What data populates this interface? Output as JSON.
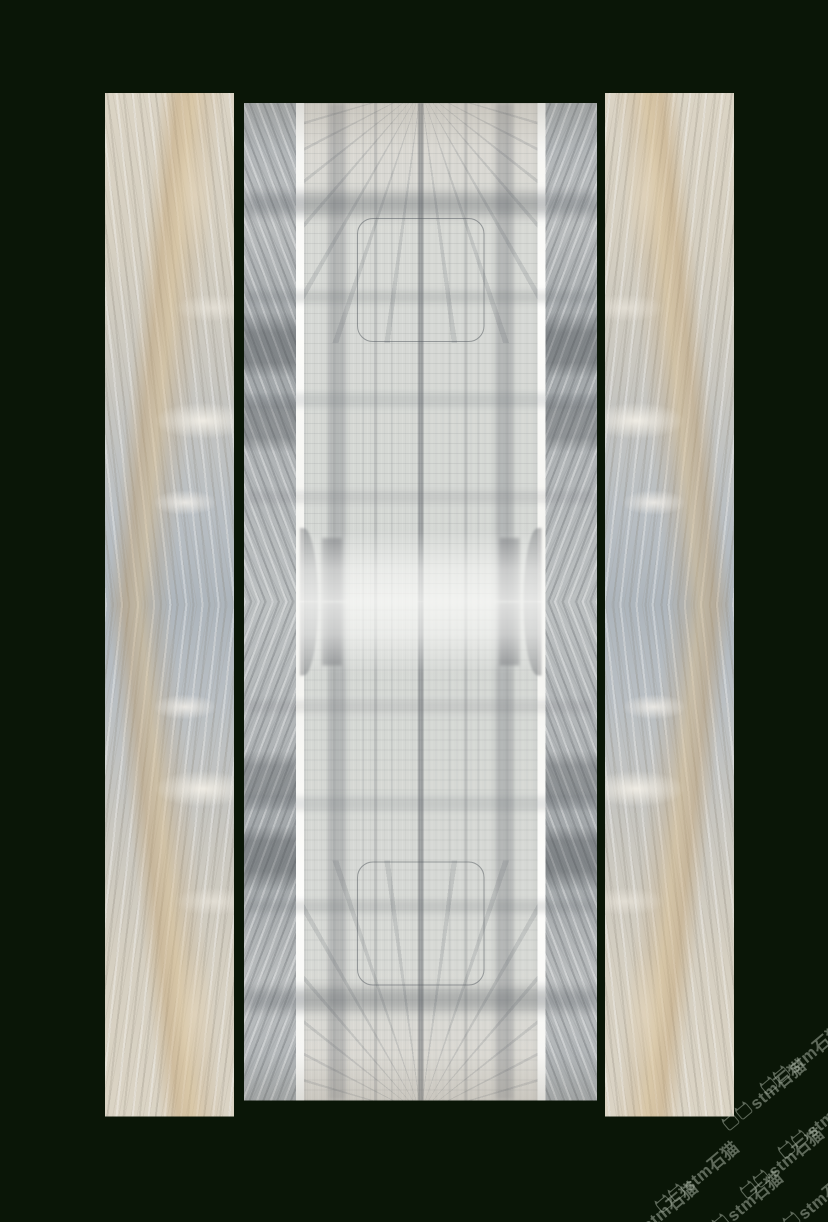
{
  "canvas": {
    "width": 828,
    "height": 1222
  },
  "colors": {
    "background": "#0a1607",
    "slab-beige": "#d8d1c3",
    "slab-bluegray": "#aeb6bc",
    "slab-tan-vein": "#c19d68",
    "panel-light": "#d6d8d4",
    "panel-strip-gray": "#a9aeb1",
    "stripe-white": "#fbfbf9",
    "watermark": "#b9c4b4"
  },
  "watermark": {
    "text": "stm石猫",
    "icon": "cat-logo-icon",
    "color": "#b9c4b4",
    "positions": [
      {
        "x": 802,
        "y": 1058
      },
      {
        "x": 764,
        "y": 1094
      },
      {
        "x": 820,
        "y": 1122
      },
      {
        "x": 782,
        "y": 1162
      },
      {
        "x": 697,
        "y": 1176
      },
      {
        "x": 741,
        "y": 1206
      },
      {
        "x": 656,
        "y": 1216
      },
      {
        "x": 812,
        "y": 1204
      }
    ]
  }
}
